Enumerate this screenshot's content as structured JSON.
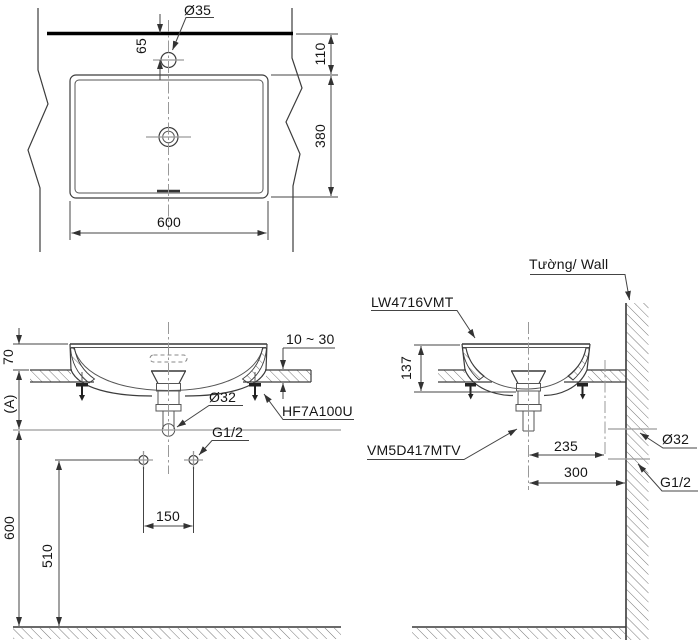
{
  "drawing": {
    "plan_view": {
      "faucet_hole_dia": "Ø35",
      "dim_hole_offset": "65",
      "dim_deck_depth": "110",
      "dim_basin_depth": "380",
      "dim_basin_width": "600"
    },
    "front_view": {
      "dim_rim_height": "70",
      "dim_trap_zone": "(A)",
      "dim_drain_height": "600",
      "dim_supply_height": "510",
      "dim_supply_spacing": "150",
      "drain_pipe_dia": "Ø32",
      "supply_thread": "G1/2",
      "drain_fitting_code": "HF7A100U",
      "counter_thickness_range": "10 ~ 30"
    },
    "side_view": {
      "wall_label": "Tường/ Wall",
      "basin_model_code": "LW4716VMT",
      "dim_basin_height": "137",
      "valve_model_code": "VM5D417MTV",
      "dim_drain_to_wall": "235",
      "dim_center_to_wall": "300",
      "drain_pipe_dia": "Ø32",
      "supply_thread": "G1/2"
    },
    "colors": {
      "line": "#3c3c3c",
      "dimension": "#444444",
      "centerline": "#999999",
      "counter_edge": "#000000",
      "background": "#ffffff"
    }
  }
}
